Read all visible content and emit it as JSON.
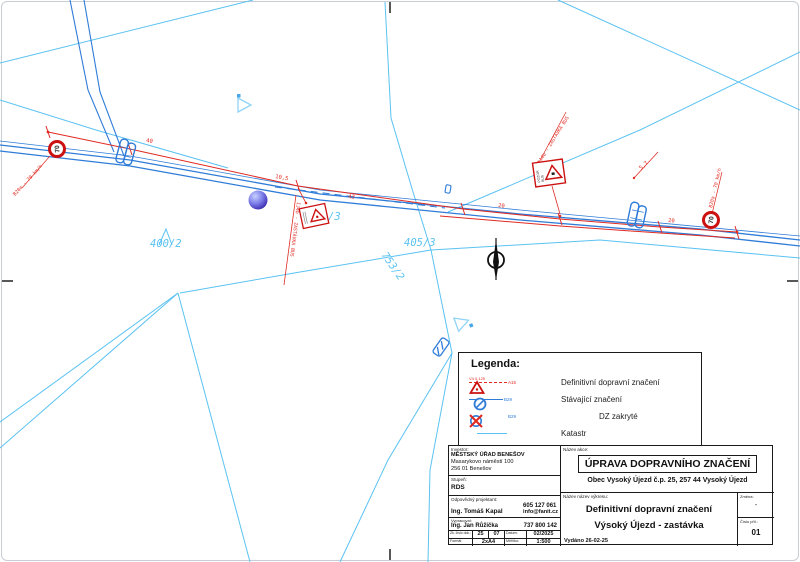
{
  "map": {
    "parcels": [
      {
        "text": "400/2"
      },
      {
        "text": "405/3"
      },
      {
        "text": "753/2"
      },
      {
        "text": "/3"
      }
    ],
    "dims": [
      {
        "text": "40"
      },
      {
        "text": "10,5"
      },
      {
        "text": "43"
      },
      {
        "text": "20"
      },
      {
        "text": "20"
      },
      {
        "text": "5,7"
      }
    ],
    "speed_sign": {
      "value": "70",
      "label": "B20a - 70 km/h"
    },
    "bus_label": "IJ4b - ZASTÁVKA BUS",
    "warning_sign": {
      "line1": "POZOR",
      "line2": "BUS"
    }
  },
  "legend": {
    "title": "Legenda:",
    "items": [
      {
        "label": "Definitivní dopravní značení",
        "sign_code": "A15",
        "mark_code": "V4 0,125"
      },
      {
        "label": "Stávající značení",
        "sign_code": "B29"
      },
      {
        "label": "DZ zakryté",
        "sign_code": "B29"
      },
      {
        "label": "Katastr"
      }
    ]
  },
  "title_block": {
    "investor_label": "Investor:",
    "investor_lines": [
      "MĚSTSKÝ ÚŘAD BENEŠOV",
      "Masarykovo náměstí 100",
      "256 01 Benešov"
    ],
    "stage_label": "Stupeň:",
    "stage_value": "RDS",
    "designer_label": "Odpovědný projektant:",
    "designer_name": "Ing. Tomáš Kapal",
    "designer_phone": "605 127 061",
    "designer_email": "info@fanit.cz",
    "author_label": "Vypracoval:",
    "author_name": "Ing. Jan Růžička",
    "author_phone": "737 800 142",
    "doc_no_label": "Zk. číslo dok.:",
    "doc_no_year": "25",
    "doc_no_seq": "07",
    "date_label": "Datum:",
    "date_value": "02/2025",
    "format_label": "Formát",
    "format_value": "2xA4",
    "scale_label": "Měřítko:",
    "scale_value": "1:500",
    "action_label": "Název akce:",
    "action_title": "ÚPRAVA DOPRAVNÍHO ZNAČENÍ",
    "action_subtitle": "Obec  Vysoký Újezd č.p. 25, 257 44 Vysoký Újezd",
    "drawing_label": "Název název výkresu:",
    "drawing_line1": "Definitivní dopravní značení",
    "drawing_line2": "Výsoký Újezd - zastávka",
    "issued": "Vydáno 26-02-25",
    "change_label": "Změna:",
    "change_value": "-",
    "sheet_label": "Číslo příl.:",
    "sheet_value": "01"
  }
}
